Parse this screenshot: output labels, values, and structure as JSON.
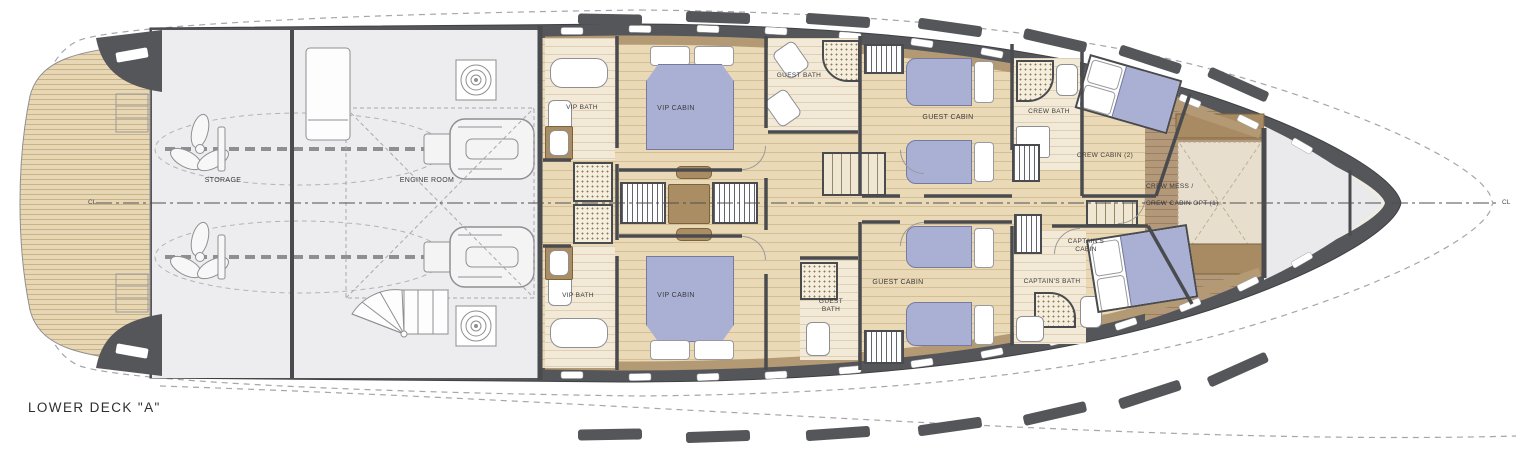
{
  "deck": {
    "title": "LOWER DECK \"A\""
  },
  "centerline": {
    "left_label": "CL",
    "right_label": "CL"
  },
  "colors": {
    "hull": "#55565a",
    "liner": "#b49a74",
    "wood_floor": "#ead9b7",
    "bed": "#aab0d4",
    "mess_wood": "#b39879",
    "machinery_floor": "#ededef"
  },
  "rooms": {
    "storage": {
      "label": "STORAGE"
    },
    "engine_room": {
      "label": "ENGINE ROOM"
    },
    "vip_bath_top": {
      "label": "VIP BATH"
    },
    "vip_cabin_top": {
      "label": "VIP CABIN"
    },
    "guest_bath_top": {
      "label": "GUEST BATH"
    },
    "guest_cabin_top": {
      "label": "GUEST CABIN"
    },
    "crew_bath": {
      "label": "CREW BATH"
    },
    "crew_cabin_2": {
      "label": "CREW CABIN (2)"
    },
    "crew_mess": {
      "line1": "CREW MESS /",
      "line2": "CREW CABIN OPT (1)"
    },
    "captains_cabin": {
      "label": "CAPTAIN'S CABIN"
    },
    "captains_bath": {
      "label": "CAPTAIN'S BATH"
    },
    "guest_cabin_bottom": {
      "label": "GUEST CABIN"
    },
    "guest_bath_bottom": {
      "label": "GUEST BATH"
    },
    "vip_cabin_bottom": {
      "label": "VIP CABIN"
    },
    "vip_bath_bottom": {
      "label": "VIP BATH"
    }
  }
}
